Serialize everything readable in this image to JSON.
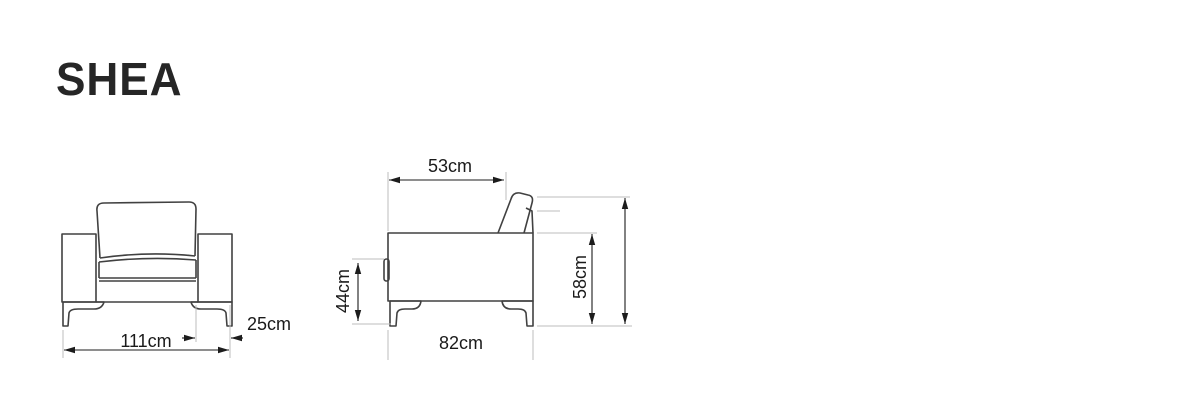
{
  "title": "SHEA",
  "colors": {
    "background": "#ffffff",
    "line_art": "#414141",
    "dimension_lines": "#1c1c1c",
    "extension_lines": "#bdbdbd",
    "text": "#1a1a1a"
  },
  "views": {
    "front": {
      "name": "front view",
      "dimensions": {
        "overall_width": "111cm",
        "arm_width": "25cm"
      }
    },
    "side": {
      "name": "side view",
      "dimensions": {
        "seat_depth": "53cm",
        "seat_height": "44cm",
        "overall_depth": "82cm",
        "arm_height": "58cm",
        "overall_height": "83cm"
      }
    }
  }
}
